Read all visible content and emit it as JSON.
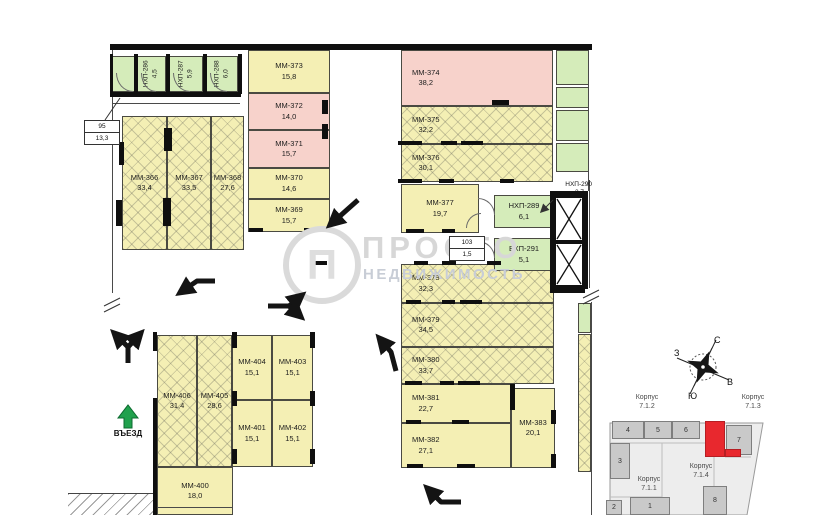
{
  "watermark": {
    "line1": "ПРОСТО",
    "line2": "НЕДВИЖИМОСТЬ"
  },
  "entrance_label": "ВЪЕЗД",
  "callout_95": {
    "top": "95",
    "bottom": "13,3"
  },
  "callout_103": {
    "top": "103",
    "bottom": "1,5"
  },
  "hall_label": {
    "name": "НХП-290",
    "area": "3,7"
  },
  "compass": {
    "north": "С",
    "south": "Ю",
    "east": "В",
    "west": "З"
  },
  "minimap": {
    "korpus_72": {
      "word": "Корпус",
      "num": "7.1.2"
    },
    "korpus_73": {
      "word": "Корпус",
      "num": "7.1.3"
    },
    "korpus_71": {
      "word": "Корпус",
      "num": "7.1.1"
    },
    "korpus_74": {
      "word": "Корпус",
      "num": "7.1.4"
    },
    "blocks": [
      {
        "label": "4",
        "x": 612,
        "y": 421,
        "w": 32,
        "h": 18
      },
      {
        "label": "5",
        "x": 644,
        "y": 421,
        "w": 28,
        "h": 18
      },
      {
        "label": "6",
        "x": 672,
        "y": 421,
        "w": 28,
        "h": 18
      },
      {
        "label": "7",
        "x": 726,
        "y": 425,
        "w": 26,
        "h": 30
      },
      {
        "label": "3",
        "x": 610,
        "y": 443,
        "w": 20,
        "h": 36
      },
      {
        "label": "8",
        "x": 703,
        "y": 486,
        "w": 24,
        "h": 29
      },
      {
        "label": "2",
        "x": 606,
        "y": 500,
        "w": 16,
        "h": 15
      },
      {
        "label": "1",
        "x": 630,
        "y": 497,
        "w": 40,
        "h": 18
      },
      {
        "label": "",
        "x": 705,
        "y": 421,
        "w": 20,
        "h": 36,
        "red": true
      },
      {
        "label": "",
        "x": 725,
        "y": 449,
        "w": 16,
        "h": 8,
        "red": true
      }
    ]
  },
  "rooms": [
    {
      "n": "",
      "a": "",
      "x": 112,
      "y": 56,
      "w": 23,
      "h": 36,
      "f": "green",
      "v": true
    },
    {
      "n": "НХП-286",
      "a": "4,5",
      "x": 137,
      "y": 56,
      "w": 29,
      "h": 36,
      "f": "green",
      "v": true
    },
    {
      "n": "НХП-287",
      "a": "5,9",
      "x": 169,
      "y": 56,
      "w": 34,
      "h": 36,
      "f": "green",
      "v": true
    },
    {
      "n": "НХП-288",
      "a": "6,0",
      "x": 206,
      "y": 56,
      "w": 32,
      "h": 36,
      "f": "green",
      "v": true
    },
    {
      "n": "ММ-366",
      "a": "33,4",
      "x": 122,
      "y": 116,
      "w": 45,
      "h": 134,
      "f": "hatch"
    },
    {
      "n": "ММ-367",
      "a": "33,5",
      "x": 167,
      "y": 116,
      "w": 44,
      "h": 134,
      "f": "hatch"
    },
    {
      "n": "ММ-368",
      "a": "27,6",
      "x": 211,
      "y": 116,
      "w": 33,
      "h": 134,
      "f": "hatch"
    },
    {
      "n": "ММ-373",
      "a": "15,8",
      "x": 248,
      "y": 50,
      "w": 82,
      "h": 43,
      "f": "yellow"
    },
    {
      "n": "ММ-372",
      "a": "14,0",
      "x": 248,
      "y": 93,
      "w": 82,
      "h": 37,
      "f": "pink"
    },
    {
      "n": "ММ-371",
      "a": "15,7",
      "x": 248,
      "y": 130,
      "w": 82,
      "h": 38,
      "f": "pink"
    },
    {
      "n": "ММ-370",
      "a": "14,6",
      "x": 248,
      "y": 168,
      "w": 82,
      "h": 31,
      "f": "yellow"
    },
    {
      "n": "ММ-369",
      "a": "15,7",
      "x": 248,
      "y": 199,
      "w": 82,
      "h": 33,
      "f": "yellow"
    },
    {
      "n": "ММ-374",
      "a": "38,2",
      "x": 401,
      "y": 50,
      "w": 152,
      "h": 56,
      "f": "pink",
      "tl": true
    },
    {
      "n": "ММ-375",
      "a": "32,2",
      "x": 401,
      "y": 106,
      "w": 152,
      "h": 38,
      "f": "hatch",
      "tl": true
    },
    {
      "n": "ММ-376",
      "a": "30,1",
      "x": 401,
      "y": 144,
      "w": 152,
      "h": 38,
      "f": "hatch",
      "tl": true
    },
    {
      "n": "ММ-377",
      "a": "19,7",
      "x": 401,
      "y": 184,
      "w": 78,
      "h": 49,
      "f": "yellow"
    },
    {
      "n": "ММ-378",
      "a": "32,3",
      "x": 401,
      "y": 264,
      "w": 153,
      "h": 39,
      "f": "hatch",
      "tl": true
    },
    {
      "n": "ММ-379",
      "a": "34,5",
      "x": 401,
      "y": 303,
      "w": 153,
      "h": 44,
      "f": "hatch",
      "tl": true
    },
    {
      "n": "ММ-380",
      "a": "33,7",
      "x": 401,
      "y": 347,
      "w": 153,
      "h": 37,
      "f": "hatch",
      "tl": true
    },
    {
      "n": "ММ-381",
      "a": "22,7",
      "x": 401,
      "y": 384,
      "w": 110,
      "h": 39,
      "f": "yellow",
      "tl": true
    },
    {
      "n": "ММ-382",
      "a": "27,1",
      "x": 401,
      "y": 423,
      "w": 110,
      "h": 45,
      "f": "yellow",
      "tl": true
    },
    {
      "n": "ММ-383",
      "a": "20,1",
      "x": 511,
      "y": 388,
      "w": 44,
      "h": 80,
      "f": "yellow"
    },
    {
      "n": "НХП-289",
      "a": "6,1",
      "x": 494,
      "y": 195,
      "w": 60,
      "h": 33,
      "f": "green"
    },
    {
      "n": "ВХП-291",
      "a": "5,1",
      "x": 494,
      "y": 238,
      "w": 60,
      "h": 33,
      "f": "green"
    },
    {
      "n": "",
      "a": "",
      "x": 556,
      "y": 50,
      "w": 33,
      "h": 35,
      "f": "green"
    },
    {
      "n": "",
      "a": "",
      "x": 556,
      "y": 87,
      "w": 33,
      "h": 21,
      "f": "green"
    },
    {
      "n": "",
      "a": "",
      "x": 556,
      "y": 110,
      "w": 33,
      "h": 31,
      "f": "green"
    },
    {
      "n": "",
      "a": "",
      "x": 556,
      "y": 143,
      "w": 33,
      "h": 29,
      "f": "green"
    },
    {
      "n": "",
      "a": "",
      "x": 578,
      "y": 303,
      "w": 13,
      "h": 30,
      "f": "green"
    },
    {
      "n": "",
      "a": "",
      "x": 578,
      "y": 334,
      "w": 13,
      "h": 138,
      "f": "hatch"
    },
    {
      "n": "ММ-406",
      "a": "31,4",
      "x": 157,
      "y": 335,
      "w": 40,
      "h": 132,
      "f": "hatch"
    },
    {
      "n": "ММ-405",
      "a": "28,6",
      "x": 197,
      "y": 335,
      "w": 35,
      "h": 132,
      "f": "hatch"
    },
    {
      "n": "ММ-404",
      "a": "15,1",
      "x": 232,
      "y": 335,
      "w": 40,
      "h": 65,
      "f": "yellow"
    },
    {
      "n": "ММ-403",
      "a": "15,1",
      "x": 272,
      "y": 335,
      "w": 41,
      "h": 65,
      "f": "yellow"
    },
    {
      "n": "ММ-401",
      "a": "15,1",
      "x": 232,
      "y": 400,
      "w": 40,
      "h": 67,
      "f": "yellow"
    },
    {
      "n": "ММ-402",
      "a": "15,1",
      "x": 272,
      "y": 400,
      "w": 41,
      "h": 67,
      "f": "yellow"
    },
    {
      "n": "ММ-400",
      "a": "18,0",
      "x": 157,
      "y": 467,
      "w": 76,
      "h": 48,
      "f": "yellow"
    }
  ],
  "wall_marks": [
    [
      110,
      44,
      482,
      6
    ],
    [
      110,
      54,
      3,
      40
    ],
    [
      134,
      54,
      4,
      40
    ],
    [
      166,
      54,
      4,
      40
    ],
    [
      203,
      54,
      4,
      40
    ],
    [
      238,
      54,
      4,
      40
    ],
    [
      110,
      92,
      131,
      5
    ],
    [
      492,
      100,
      17,
      5
    ],
    [
      322,
      100,
      6,
      14
    ],
    [
      322,
      124,
      6,
      15
    ],
    [
      398,
      141,
      24,
      4
    ],
    [
      441,
      141,
      16,
      4
    ],
    [
      461,
      141,
      22,
      4
    ],
    [
      398,
      179,
      24,
      4
    ],
    [
      439,
      179,
      15,
      4
    ],
    [
      500,
      179,
      14,
      4
    ],
    [
      406,
      229,
      18,
      4
    ],
    [
      442,
      229,
      13,
      4
    ],
    [
      249,
      228,
      14,
      4
    ],
    [
      304,
      228,
      18,
      4
    ],
    [
      313,
      261,
      14,
      4
    ],
    [
      414,
      261,
      14,
      4
    ],
    [
      442,
      261,
      14,
      4
    ],
    [
      487,
      261,
      14,
      4
    ],
    [
      406,
      300,
      15,
      4
    ],
    [
      442,
      300,
      13,
      4
    ],
    [
      460,
      300,
      22,
      4
    ],
    [
      405,
      381,
      17,
      4
    ],
    [
      440,
      381,
      14,
      4
    ],
    [
      458,
      381,
      22,
      4
    ],
    [
      406,
      420,
      15,
      4
    ],
    [
      452,
      420,
      17,
      4
    ],
    [
      407,
      464,
      16,
      4
    ],
    [
      457,
      464,
      18,
      4
    ],
    [
      510,
      384,
      5,
      26
    ],
    [
      551,
      410,
      5,
      14
    ],
    [
      551,
      454,
      5,
      14
    ],
    [
      232,
      332,
      5,
      16
    ],
    [
      310,
      332,
      5,
      16
    ],
    [
      153,
      332,
      4,
      19
    ],
    [
      232,
      391,
      5,
      15
    ],
    [
      310,
      391,
      5,
      15
    ],
    [
      232,
      449,
      5,
      15
    ],
    [
      310,
      449,
      5,
      15
    ],
    [
      153,
      398,
      4,
      117
    ],
    [
      164,
      128,
      8,
      23
    ],
    [
      119,
      142,
      5,
      23
    ],
    [
      116,
      200,
      6,
      26
    ],
    [
      163,
      198,
      8,
      28
    ]
  ]
}
